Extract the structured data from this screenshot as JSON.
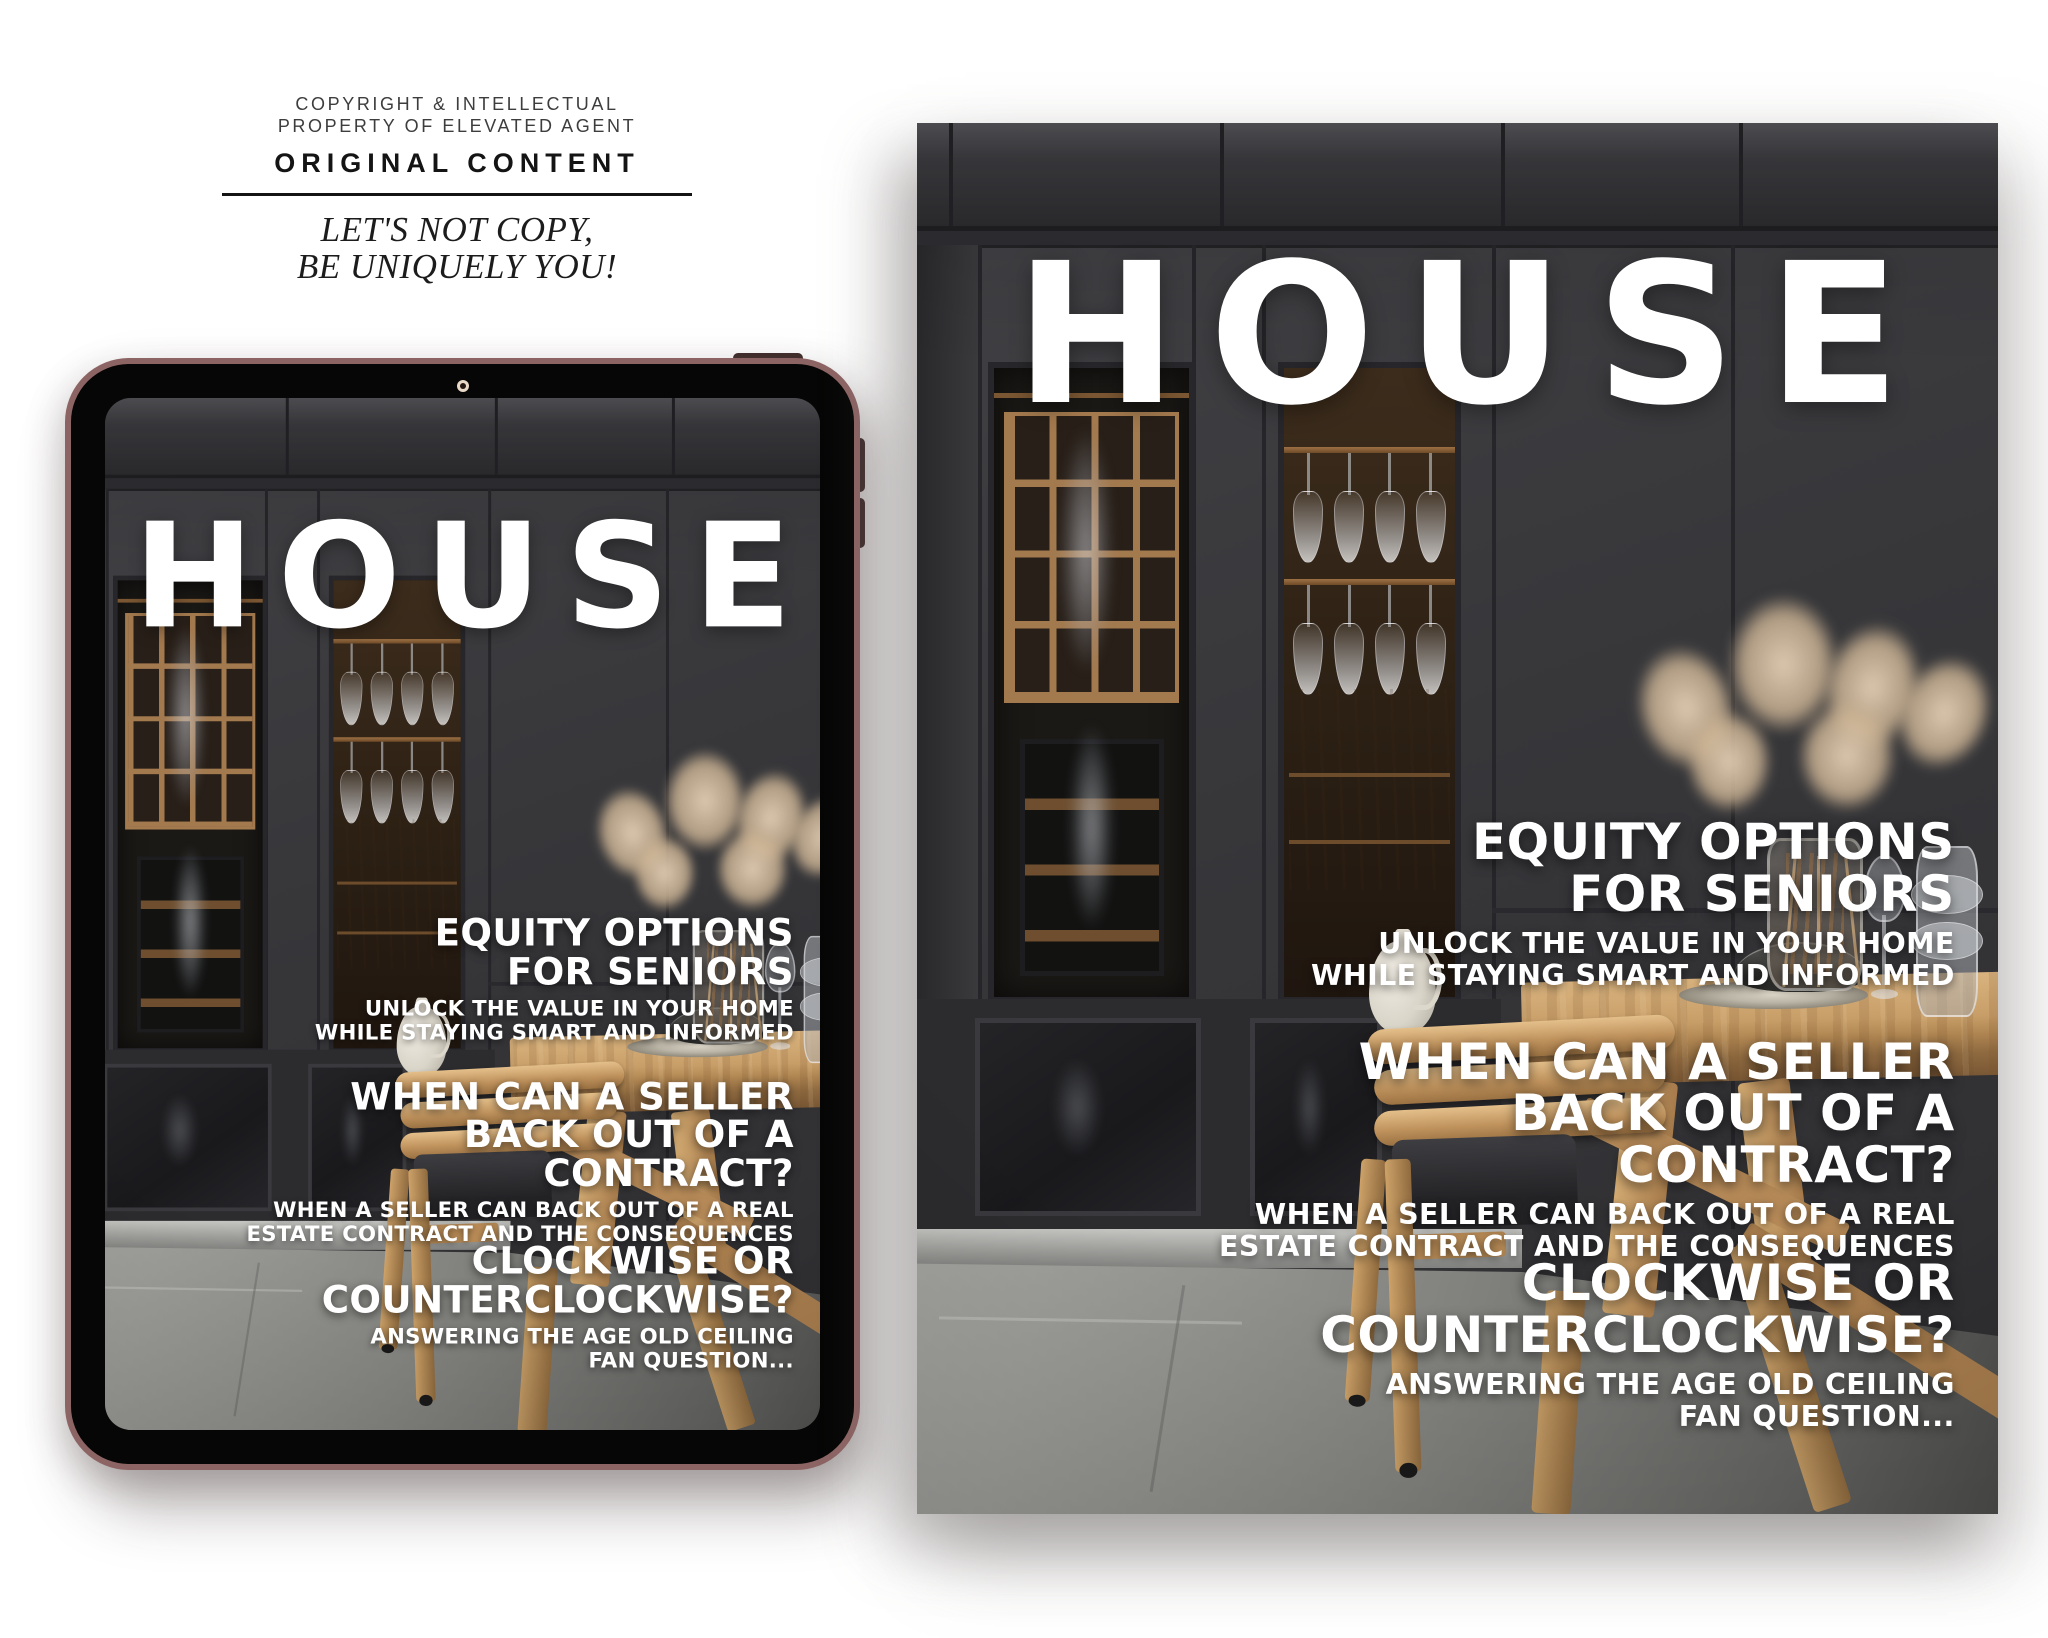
{
  "branding": {
    "copyright_line1": "COPYRIGHT & INTELLECTUAL",
    "copyright_line2": "PROPERTY OF ELEVATED AGENT",
    "original_content": "ORIGINAL CONTENT",
    "tagline_line1": "LET'S NOT COPY,",
    "tagline_line2": "BE UNIQUELY YOU!"
  },
  "cover": {
    "title": "HOUSE",
    "features": [
      {
        "lines": [
          "EQUITY OPTIONS",
          "FOR SENIORS"
        ],
        "sub": [
          "UNLOCK THE VALUE IN YOUR HOME",
          "WHILE STAYING SMART AND INFORMED"
        ]
      },
      {
        "lines": [
          "WHEN CAN A SELLER",
          "BACK OUT OF A",
          "CONTRACT?"
        ],
        "sub": [
          "WHEN A SELLER CAN BACK OUT OF A REAL",
          "ESTATE CONTRACT AND THE CONSEQUENCES"
        ]
      },
      {
        "lines": [
          "CLOCKWISE OR",
          "COUNTERCLOCKWISE?"
        ],
        "sub": [
          "ANSWERING THE AGE OLD CEILING",
          "FAN QUESTION..."
        ]
      }
    ]
  },
  "colors": {
    "page_background": "#ffffff",
    "tablet_frame": "#8d6464",
    "cover_text": "#ffffff",
    "cabinet_dark": "#343437",
    "wood_tan": "#a3794e",
    "table_oak": "#c89e68",
    "floor_grey": "#8f8f8b",
    "pampas_tan": "#cdb292"
  }
}
